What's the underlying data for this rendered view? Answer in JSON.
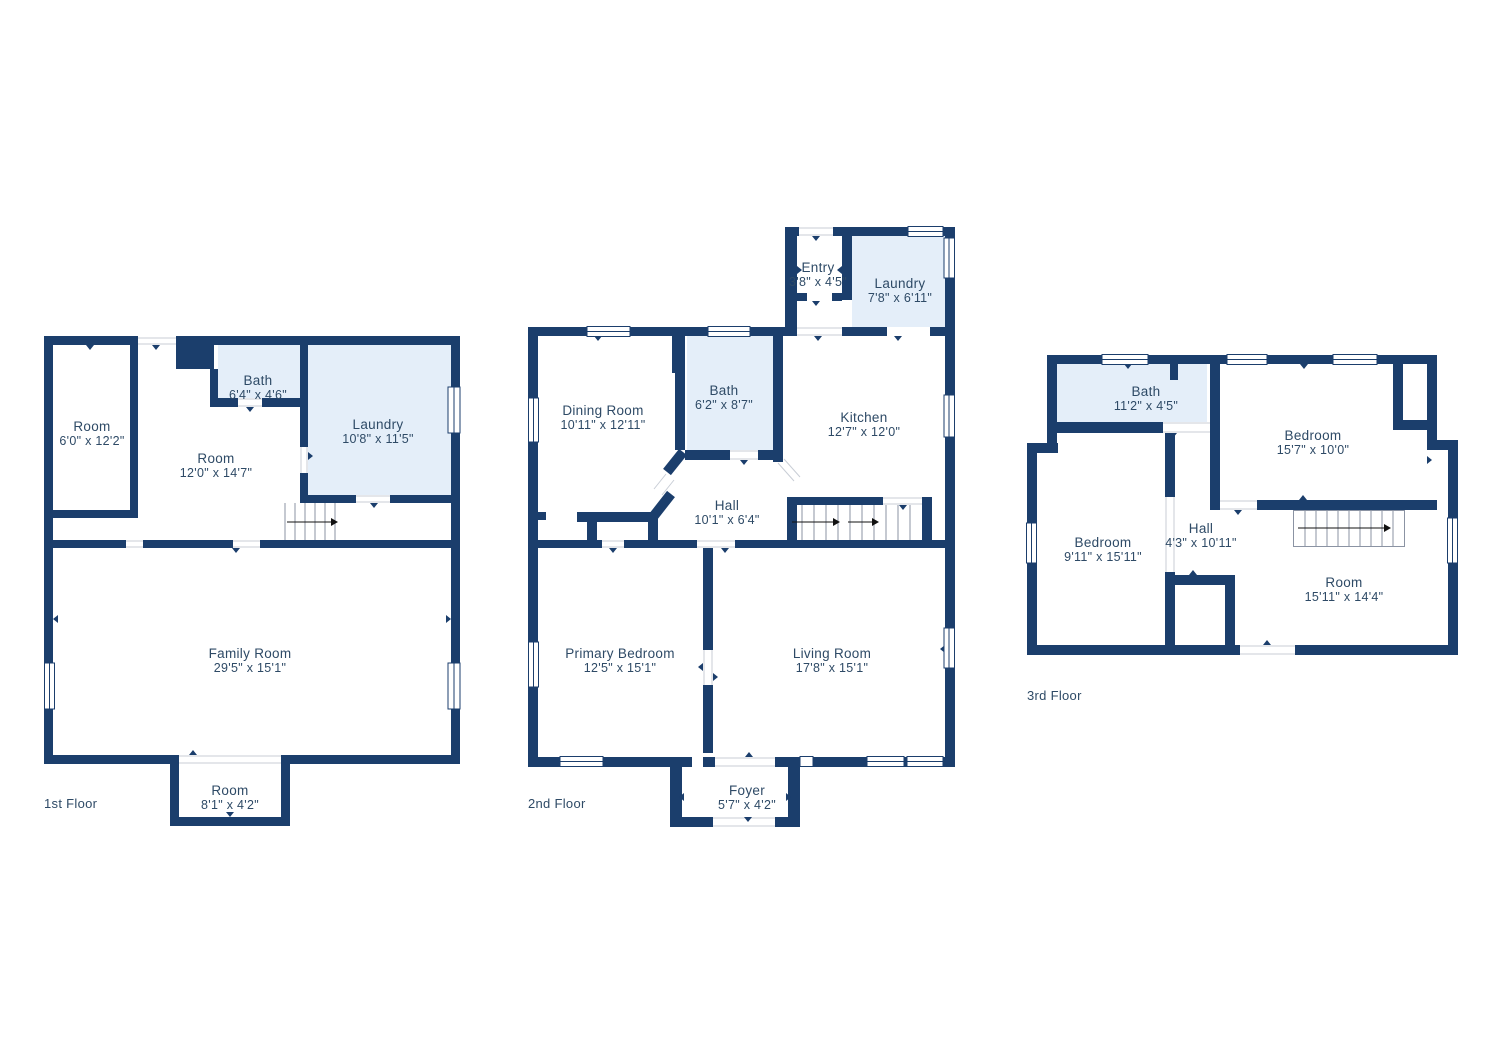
{
  "palette": {
    "wall": "#1b3e6c",
    "room_highlight": "#e4eef9",
    "text": "#2e4a66",
    "background": "#ffffff",
    "stair_line": "#8b93a3",
    "arrow": "#111111",
    "jamb": "#c9ced6"
  },
  "floors": [
    {
      "label": "1st Floor",
      "rooms": [
        {
          "name": "Room",
          "dims": "6'0\" x 12'2\""
        },
        {
          "name": "Bath",
          "dims": "6'4\" x 4'6\""
        },
        {
          "name": "Room",
          "dims": "12'0\" x 14'7\""
        },
        {
          "name": "Laundry",
          "dims": "10'8\" x 11'5\""
        },
        {
          "name": "Family Room",
          "dims": "29'5\" x 15'1\""
        },
        {
          "name": "Room",
          "dims": "8'1\" x 4'2\""
        }
      ]
    },
    {
      "label": "2nd Floor",
      "rooms": [
        {
          "name": "Entry",
          "dims": "3'8\" x 4'5\""
        },
        {
          "name": "Laundry",
          "dims": "7'8\" x 6'11\""
        },
        {
          "name": "Dining Room",
          "dims": "10'11\" x 12'11\""
        },
        {
          "name": "Bath",
          "dims": "6'2\" x 8'7\""
        },
        {
          "name": "Kitchen",
          "dims": "12'7\" x 12'0\""
        },
        {
          "name": "Hall",
          "dims": "10'1\" x 6'4\""
        },
        {
          "name": "Primary Bedroom",
          "dims": "12'5\" x 15'1\""
        },
        {
          "name": "Living Room",
          "dims": "17'8\" x 15'1\""
        },
        {
          "name": "Foyer",
          "dims": "5'7\" x 4'2\""
        }
      ]
    },
    {
      "label": "3rd Floor",
      "rooms": [
        {
          "name": "Bath",
          "dims": "11'2\" x 4'5\""
        },
        {
          "name": "Bedroom",
          "dims": "15'7\" x 10'0\""
        },
        {
          "name": "Bedroom",
          "dims": "9'11\" x 15'11\""
        },
        {
          "name": "Hall",
          "dims": "4'3\" x 10'11\""
        },
        {
          "name": "Room",
          "dims": "15'11\" x 14'4\""
        }
      ]
    }
  ]
}
